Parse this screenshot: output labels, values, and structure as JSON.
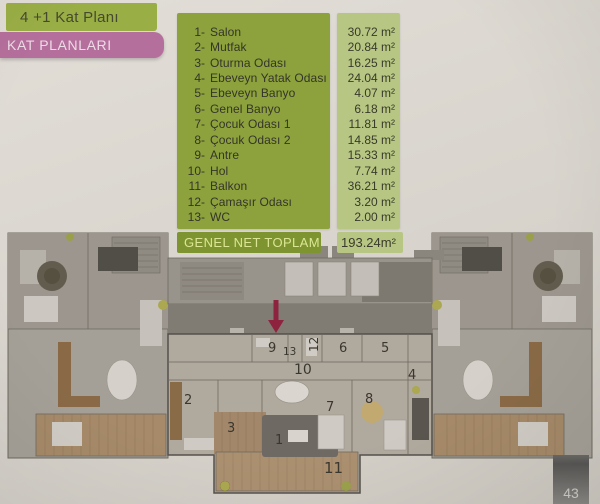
{
  "page": {
    "title": "4 +1 Kat Planı",
    "section_label": "KAT PLANLARI",
    "page_number": "43"
  },
  "legend": {
    "rooms": [
      {
        "no": "1-",
        "label": "Salon",
        "area": "30.72 m²"
      },
      {
        "no": "2-",
        "label": "Mutfak",
        "area": "20.84 m²"
      },
      {
        "no": "3-",
        "label": "Oturma Odası",
        "area": "16.25 m²"
      },
      {
        "no": "4-",
        "label": "Ebeveyn Yatak Odası",
        "area": "24.04 m²"
      },
      {
        "no": "5-",
        "label": "Ebeveyn Banyo",
        "area": "4.07 m²"
      },
      {
        "no": "6-",
        "label": "Genel Banyo",
        "area": "6.18 m²"
      },
      {
        "no": "7-",
        "label": "Çocuk Odası 1",
        "area": "11.81 m²"
      },
      {
        "no": "8-",
        "label": "Çocuk Odası 2",
        "area": "14.85 m²"
      },
      {
        "no": "9-",
        "label": "Antre",
        "area": "15.33 m²"
      },
      {
        "no": "10-",
        "label": "Hol",
        "area": "7.74 m²"
      },
      {
        "no": "11-",
        "label": "Balkon",
        "area": "36.21 m²"
      },
      {
        "no": "12-",
        "label": "Çamaşır Odası",
        "area": "3.20 m²"
      },
      {
        "no": "13-",
        "label": "WC",
        "area": "2.00 m²"
      }
    ],
    "total_label": "GENEL NET TOPLAM",
    "total_value": "193.24m²"
  },
  "plan": {
    "labels": [
      "1",
      "2",
      "3",
      "4",
      "5",
      "6",
      "7",
      "8",
      "9",
      "10",
      "11",
      "12",
      "13"
    ]
  },
  "colors": {
    "legend_green": "#8da23c",
    "area_strip_green": "#b7c682",
    "total_bar_green": "#7d9430",
    "ribbon_pink": "#b56f9c",
    "paper": "#d9d5ce",
    "plan_gray": "#a5a097",
    "balcony_wood": "#a68a69",
    "entrance_arrow_red": "#8e2340",
    "page_tab_gray": "#6b6a67"
  }
}
